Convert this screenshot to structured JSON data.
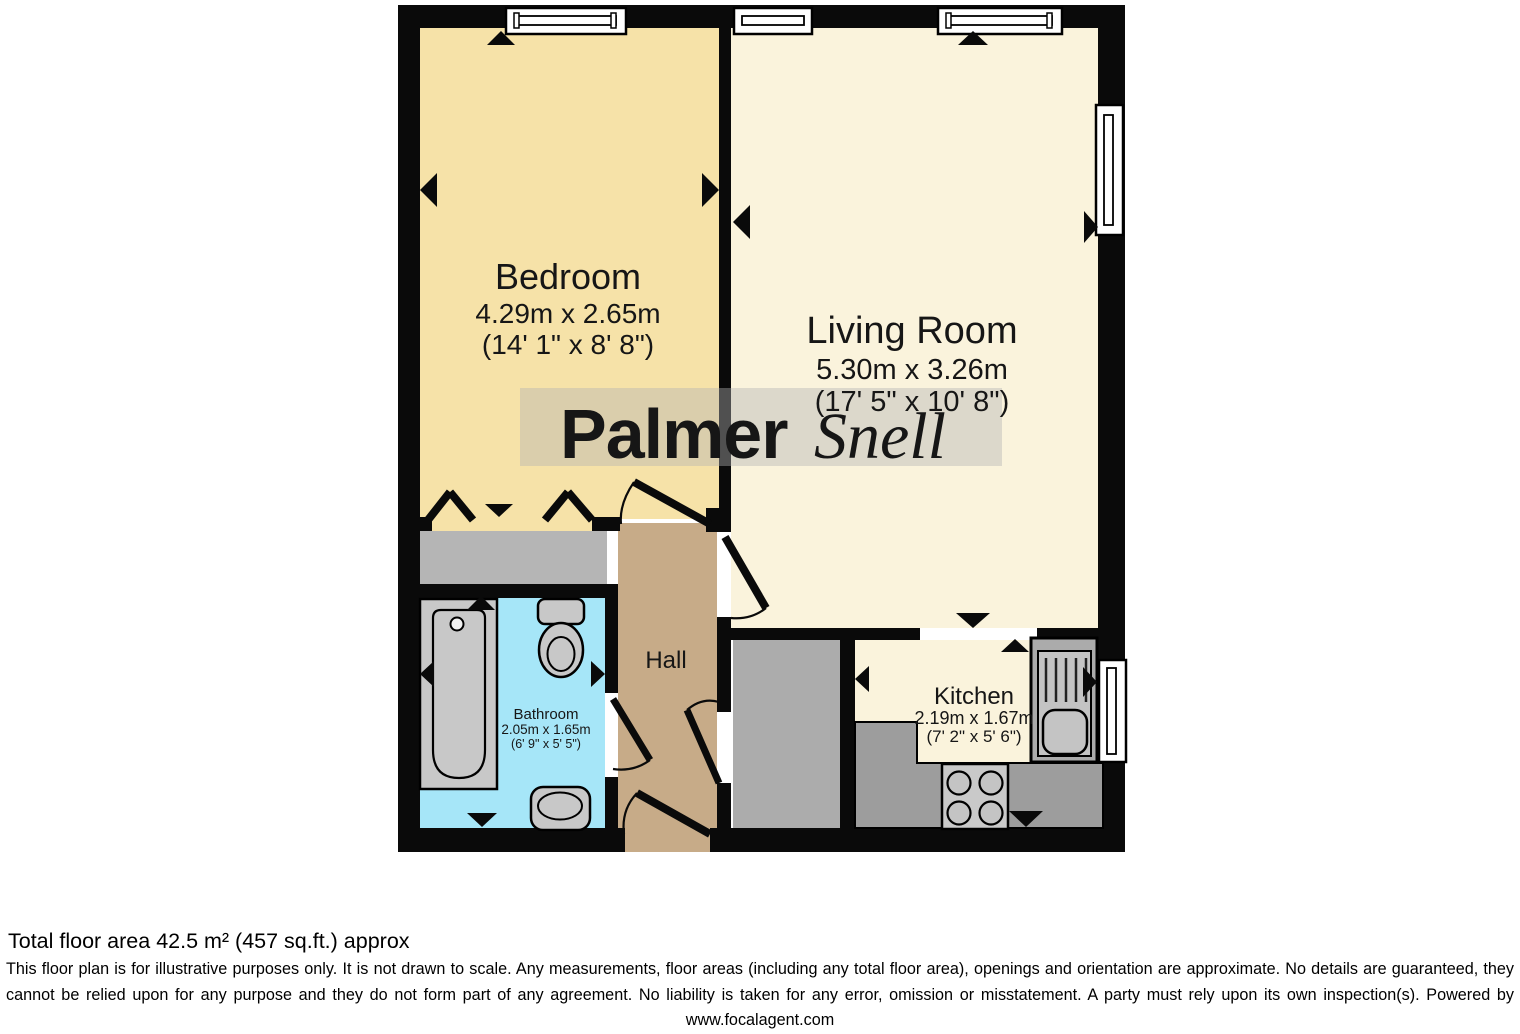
{
  "rooms": {
    "bedroom": {
      "name": "Bedroom",
      "dims_metric": "4.29m x 2.65m",
      "dims_imperial": "(14' 1\" x 8' 8\")"
    },
    "living_room": {
      "name": "Living Room",
      "dims_metric": "5.30m x 3.26m",
      "dims_imperial": "(17' 5\" x 10' 8\")"
    },
    "hall": {
      "name": "Hall"
    },
    "kitchen": {
      "name": "Kitchen",
      "dims_metric": "2.19m x 1.67m",
      "dims_imperial": "(7' 2\" x 5' 6\")"
    },
    "bathroom": {
      "name": "Bathroom",
      "dims_metric": "2.05m x 1.65m",
      "dims_imperial": "(6' 9\" x 5' 5\")"
    }
  },
  "watermark": {
    "part1": "Palmer",
    "part2": "Snell"
  },
  "colors": {
    "bedroom": "#F6E2A8",
    "living_room": "#FAF3DC",
    "kitchen_floor": "#FAF3DC",
    "hall": "#C7AB88",
    "bathroom": "#A6E6F8",
    "wardrobe": "#B5B5B5",
    "storage": "#ACACAC",
    "counter": "#9D9D9D",
    "fixture": "#C8C8C8",
    "wall": "#0A0A0A",
    "window": "#FFFFFF"
  },
  "footer": {
    "total_area": "Total floor area 42.5 m² (457 sq.ft.) approx",
    "disclaimer": "This floor plan is for illustrative purposes only. It is not drawn to scale. Any measurements, floor areas (including any total floor area), openings and orientation are approximate. No details are guaranteed, they cannot be relied upon for any purpose and they do not form part of any agreement. No liability is taken for any error, omission or misstatement. A party must rely upon its own inspection(s). Powered by www.focalagent.com"
  }
}
